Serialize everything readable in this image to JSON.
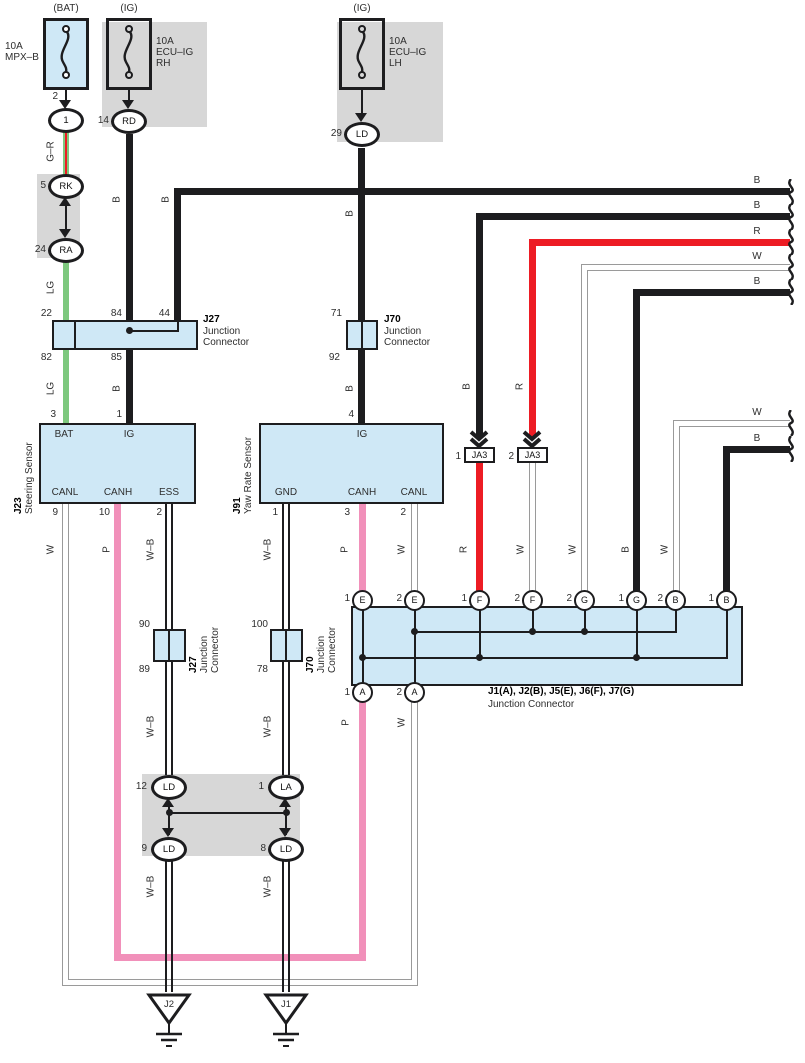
{
  "wire": {
    "B": "B",
    "R": "R",
    "W": "W",
    "P": "P",
    "WB": "W–B",
    "LG": "LG",
    "GR": "G–R"
  },
  "fuse_bat": {
    "header": "(BAT)",
    "rating": "10A",
    "name": "MPX–B",
    "pin": "2",
    "conn": "1"
  },
  "fuse_rh": {
    "header": "(IG)",
    "rating": "10A",
    "name1": "ECU–IG",
    "name2": "RH",
    "pin": "14",
    "term": "RD"
  },
  "fuse_lh": {
    "header": "(IG)",
    "rating": "10A",
    "name1": "ECU–IG",
    "name2": "LH",
    "pin": "29",
    "term": "LD"
  },
  "relay": {
    "pin_top": "5",
    "term_top": "RK",
    "pin_bottom": "24",
    "term_bottom": "RA"
  },
  "j27u": {
    "id": "J27",
    "line1": "Junction",
    "line2": "Connector",
    "p22": "22",
    "p84": "84",
    "p44": "44",
    "p82": "82",
    "p85": "85"
  },
  "j70u": {
    "id": "J70",
    "line1": "Junction",
    "line2": "Connector",
    "p71": "71",
    "p92": "92"
  },
  "j23": {
    "id": "J23",
    "name": "Steering Sensor",
    "bat": "BAT",
    "ig": "IG",
    "canl": "CANL",
    "canh": "CANH",
    "ess": "ESS",
    "pin_bat": "3",
    "pin_ig": "1",
    "pin_canl": "9",
    "pin_canh": "10",
    "pin_ess": "2"
  },
  "j91": {
    "id": "J91",
    "name": "Yaw Rate Sensor",
    "ig": "IG",
    "gnd": "GND",
    "canh": "CANH",
    "canl": "CANL",
    "pin_ig": "4",
    "pin_gnd": "1",
    "pin_canh": "3",
    "pin_canl": "2"
  },
  "ja3": {
    "label": "JA3",
    "pin1": "1",
    "pin2": "2"
  },
  "jc": {
    "title": "J1(A), J2(B), J5(E), J6(F), J7(G)",
    "subtitle": "Junction Connector",
    "top": [
      {
        "n": "1",
        "t": "E"
      },
      {
        "n": "2",
        "t": "E"
      },
      {
        "n": "1",
        "t": "F"
      },
      {
        "n": "2",
        "t": "F"
      },
      {
        "n": "2",
        "t": "G"
      },
      {
        "n": "1",
        "t": "G"
      },
      {
        "n": "2",
        "t": "B"
      },
      {
        "n": "1",
        "t": "B"
      }
    ],
    "bottom": [
      {
        "n": "1",
        "t": "A"
      },
      {
        "n": "2",
        "t": "A"
      }
    ]
  },
  "j27l": {
    "id": "J27",
    "line1": "Junction",
    "line2": "Connector",
    "pt": "90",
    "pb": "89"
  },
  "j70l": {
    "id": "J70",
    "line1": "Junction",
    "line2": "Connector",
    "pt": "100",
    "pb": "78"
  },
  "shield": {
    "pin_tl": "12",
    "term_tl": "LD",
    "pin_tr": "1",
    "term_tr": "LA",
    "pin_bl": "9",
    "term_bl": "LD",
    "pin_br": "8",
    "term_br": "LD"
  },
  "ground": {
    "left": "J2",
    "right": "J1"
  },
  "colors": {
    "black": "#1d1d1f",
    "red": "#ed1c24",
    "pink": "#f190ba",
    "green": "#7dc87e",
    "white_wire": "#9a9a9a",
    "blue_box": "#cfe8f6",
    "gray_box": "#d7d7d7"
  }
}
